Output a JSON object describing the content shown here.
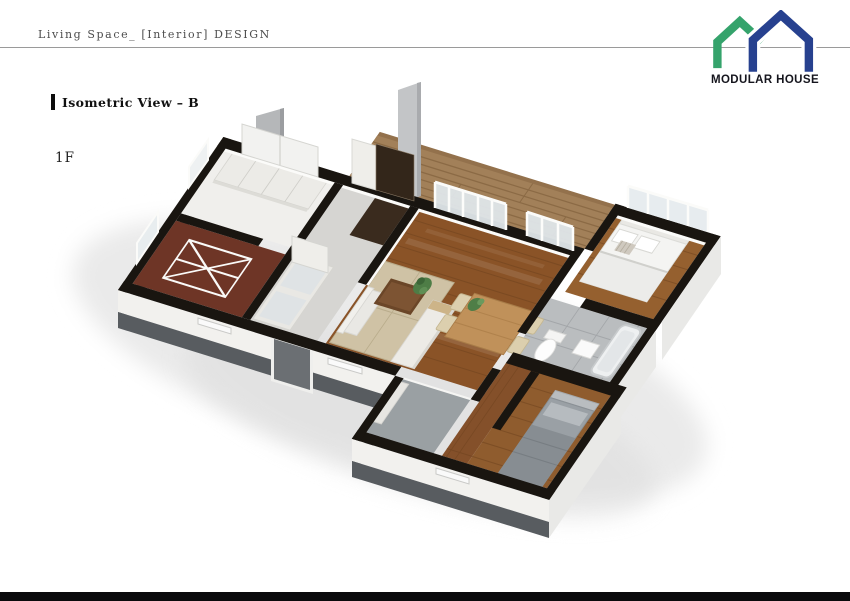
{
  "header": {
    "title": "Living Space_ [Interior] DESIGN"
  },
  "logo": {
    "text": "MODULAR HOUSE",
    "green": "#35a36c",
    "blue": "#27418f"
  },
  "annotations": {
    "view_label": "Isometric View – B",
    "floor_label": "1F"
  },
  "floorplan": {
    "description": "Isometric 3D cutaway rendering of modular house, first floor",
    "palette": {
      "wall": "#191510",
      "wall_face_white": "#f2f1ee",
      "tile_band": "#585c60",
      "side_face": "#e9e9e7",
      "deck_wood": "#a28059",
      "living_wood": "#8a5327",
      "bedroom_wood": "#95602f",
      "bedroom2_wood": "#8f5c2e",
      "corridor_wood": "#84502a",
      "tatami": "#cfc2a5",
      "hall_floor": "#d6d5d2",
      "utility_floor": "#6e3526",
      "bath_floor": "#babdbf",
      "entry_floor": "#9aa0a3",
      "glass": "#dfe6ea",
      "door_gray": "#6b6f73"
    },
    "rooms": [
      "closet room",
      "utility room",
      "hallway",
      "living / dining",
      "wood deck",
      "main bedroom",
      "bathroom",
      "corridor",
      "second bedroom",
      "entry"
    ]
  },
  "footer": {
    "bar_color": "#0a0a0c"
  }
}
